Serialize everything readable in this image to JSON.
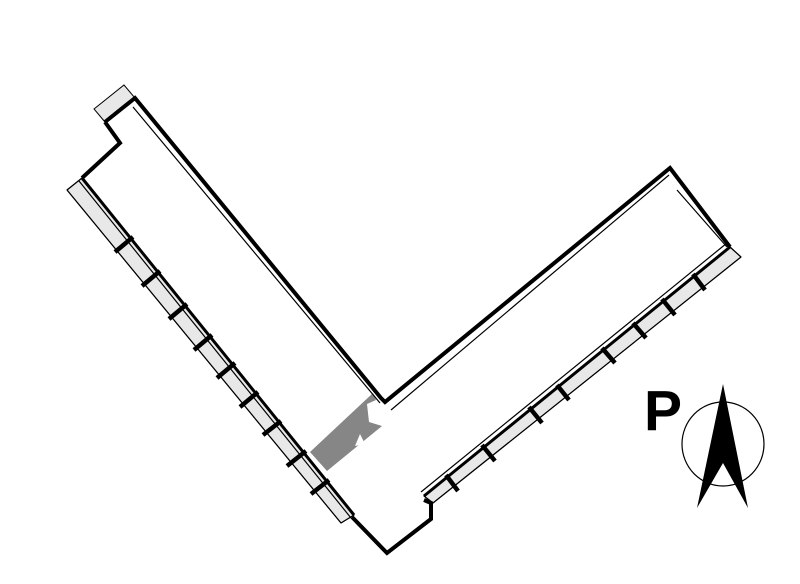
{
  "colors": {
    "background": "#ffffff",
    "wall": "#000000",
    "balcony": "#e8e8e8",
    "unit": "#868686"
  },
  "plan": {
    "outline_path": "M105,122 L135,98 L381,398 L385,402 L670,168 L730,247 M105,122 L120,143 L82,178 M424,500 L431,503 L431,519 L387,553 L352,517",
    "band_walls_path": "M82,178 L354,515 M730,247 L424,496",
    "top_balcony_path": "M94,109 L124,85 L135,98 L105,122 Z",
    "left_band_path": "M82,178 L67,190 L341,523 L354,515 Z",
    "right_band_path": "M730,247 L741,257 L433,503 L424,496 Z",
    "left_dividers_path": "M133,237 L115,252 M160,271 L142,286 M187,304 L169,319 M212,335 L194,350 M235,363 L217,378 M258,392 L240,407 M281,421 L263,435 M306,451 L287,466 M329,480 L311,494",
    "right_dividers_path": "M693,274 L705,290 M662,299 L675,315 M633,323 L646,338 M602,348 L615,363 M557,385 L569,400 M529,407 L542,423 M482,445 L495,461 M446,475 L458,491",
    "unit_path": "M373,393 L376,400 L367,404 L369,422 L382,426 L327,471 L310,452 Z",
    "unit_notch_path": "M355,446 L360,434 L365,444 Z",
    "thin_lines_path": "M67,190 L341,523 M82,178 L67,190 M354,515 L341,523 M741,257 L433,503 M730,247 L741,257 M424,496 L433,503 M133,107 L380,403 M391,410 L669,175 M677,190 L727,247 M727,243 L421,492 M79,181 L351,518"
  },
  "compass": {
    "label": "P",
    "circle_path": "M682,444 a41,42 0 1,0 82,0 a41,42 0 1,0 -82,0",
    "arrow_path": "M723,384 L748,508 L723,463 L697,508 Z"
  }
}
